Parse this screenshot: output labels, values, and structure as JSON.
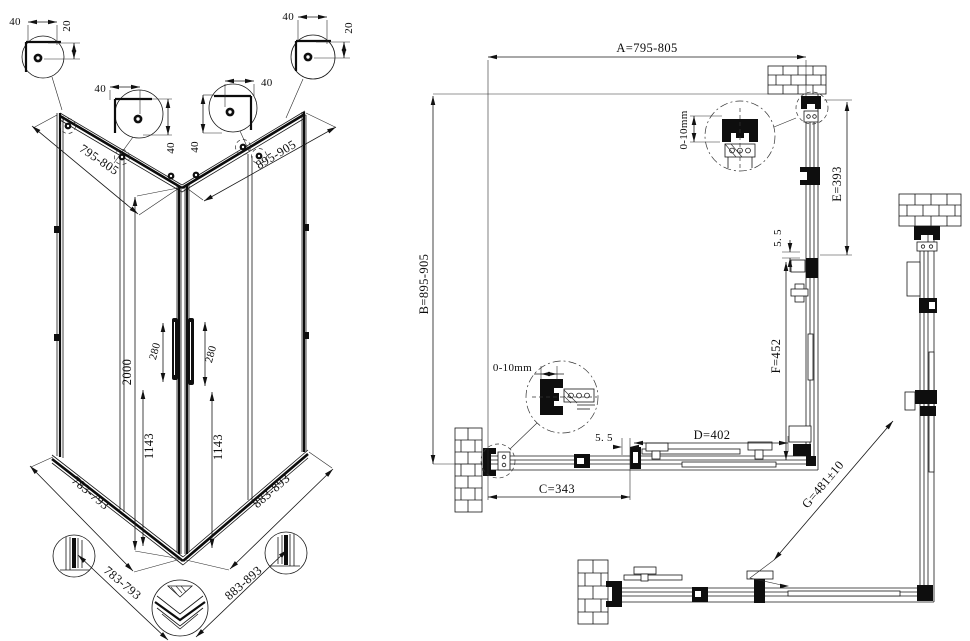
{
  "iso_view": {
    "top_width": "795-805",
    "top_depth": "895-905",
    "height": "2000",
    "handle_left": "280",
    "handle_right": "280",
    "door_glass_left": "1143",
    "door_glass_right": "1143",
    "bottom_width": "783-793",
    "bottom_depth": "883-893",
    "base_width": "783-793",
    "base_depth": "883-893",
    "corner_detail_1": {
      "offset": "40",
      "drop": "20"
    },
    "corner_detail_2": {
      "offset": "40",
      "drop": "40"
    },
    "corner_detail_3": {
      "offset": "40",
      "drop": "40"
    },
    "corner_detail_4": {
      "offset": "40",
      "drop": "20"
    }
  },
  "plan_view": {
    "width_a": "A=795-805",
    "depth_b": "B=895-905",
    "wall_profile_adjust_top": "0-10mm",
    "wall_profile_adjust_side": "0-10mm",
    "fixed_panel_e": "E=393",
    "gap_top": "5. 5",
    "door_panel_f": "F=452",
    "gap_side": "5. 5",
    "door_panel_d": "D=402",
    "fixed_panel_c": "C=343",
    "diagonal_opening_g": "G=481±10"
  }
}
